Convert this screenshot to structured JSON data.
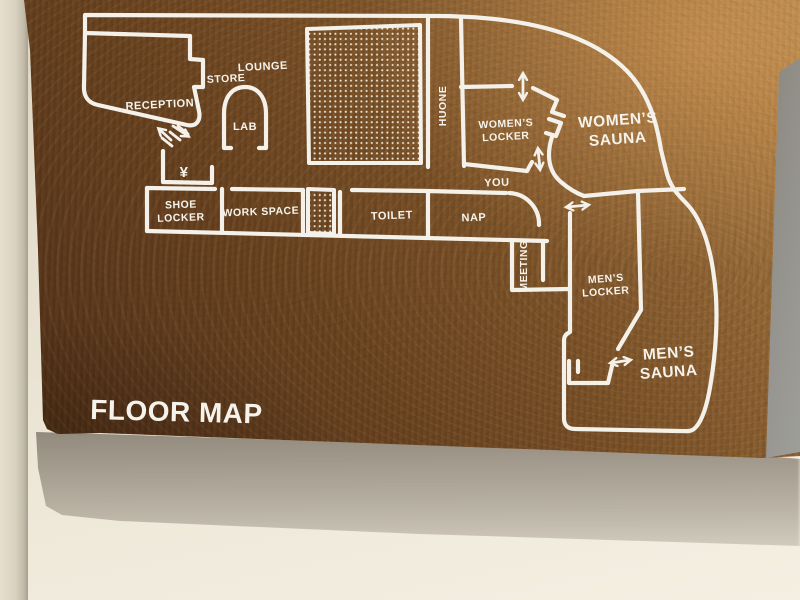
{
  "sign": {
    "title": "FLOOR MAP",
    "rooms": {
      "reception": "RECEPTION",
      "store": "STORE",
      "lounge": "LOUNGE",
      "lab": "LAB",
      "shoe_locker": [
        "SHOE",
        "LOCKER"
      ],
      "work_space": "WORK SPACE",
      "toilet": "TOILET",
      "nap": "NAP",
      "huone": "HUONE",
      "meeting": "MEETING",
      "womens_locker": [
        "WOMEN’S",
        "LOCKER"
      ],
      "womens_sauna": [
        "WOMEN’S",
        "SAUNA"
      ],
      "mens_locker": [
        "MEN’S",
        "LOCKER"
      ],
      "mens_sauna": [
        "MEN’S",
        "SAUNA"
      ]
    },
    "markers": {
      "you": "YOU",
      "yen": "¥"
    },
    "colors": {
      "line": "#f4f1ea",
      "wood_dark": "#46290f",
      "wood_light": "#b08449",
      "wall": "#ece5d6",
      "shadow": "#6b6156"
    }
  }
}
